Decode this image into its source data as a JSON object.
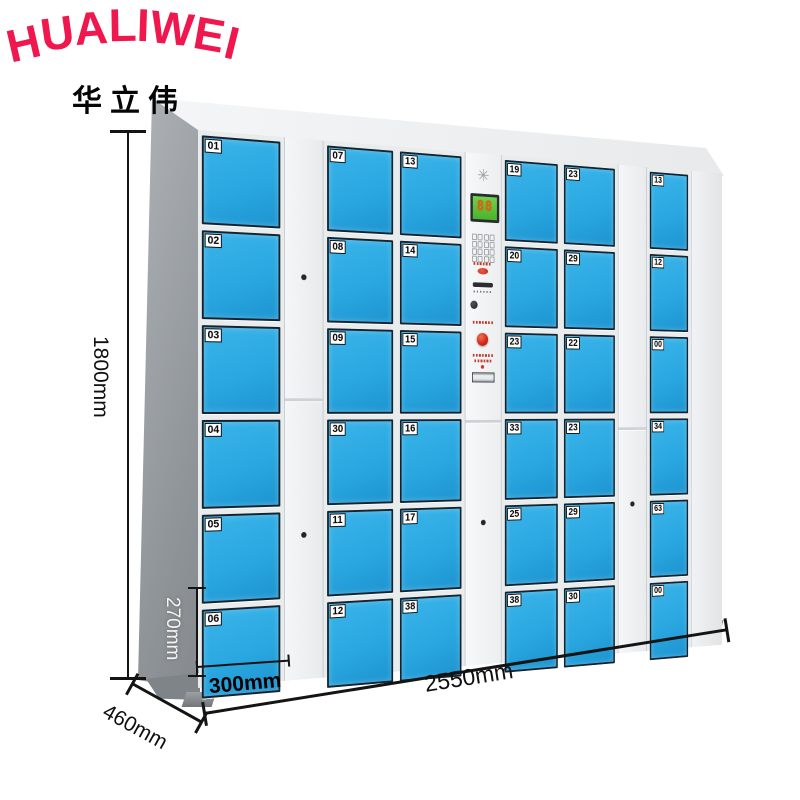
{
  "brand": {
    "name": "HUALIWEI",
    "chinese": "华立伟",
    "logo_color": "#f0164e"
  },
  "dimensions": {
    "total_height": "1800mm",
    "door_height": "270mm",
    "door_width": "300mm",
    "depth": "460mm",
    "total_width": "2550mm"
  },
  "locker": {
    "door_color": "#2aa7e0",
    "frame_color": "#e9eced",
    "side_color": "#8f9498",
    "door_columns": [
      {
        "numbers": [
          "01",
          "02",
          "03",
          "04",
          "05",
          "06"
        ]
      },
      {
        "numbers": [
          "07",
          "08",
          "09",
          "30",
          "11",
          "12"
        ]
      },
      {
        "numbers": [
          "13",
          "14",
          "15",
          "16",
          "17",
          "38"
        ]
      },
      {
        "numbers": [
          "19",
          "20",
          "23",
          "33",
          "25",
          "38"
        ]
      },
      {
        "numbers": [
          "23",
          "29",
          "22",
          "23",
          "29",
          "30"
        ]
      },
      {
        "numbers": [
          "13",
          "12",
          "00",
          "34",
          "63",
          "00"
        ]
      }
    ],
    "panel": {
      "display_value": "88",
      "display_bg": "#5cc43d",
      "display_digit_color": "#e8600f",
      "starburst_glyph": "✳",
      "icons": [
        "starburst-icon",
        "led-display",
        "keypad",
        "indicator-light",
        "card-slot",
        "scanner-lens",
        "start-button",
        "instruction-plate"
      ]
    }
  }
}
